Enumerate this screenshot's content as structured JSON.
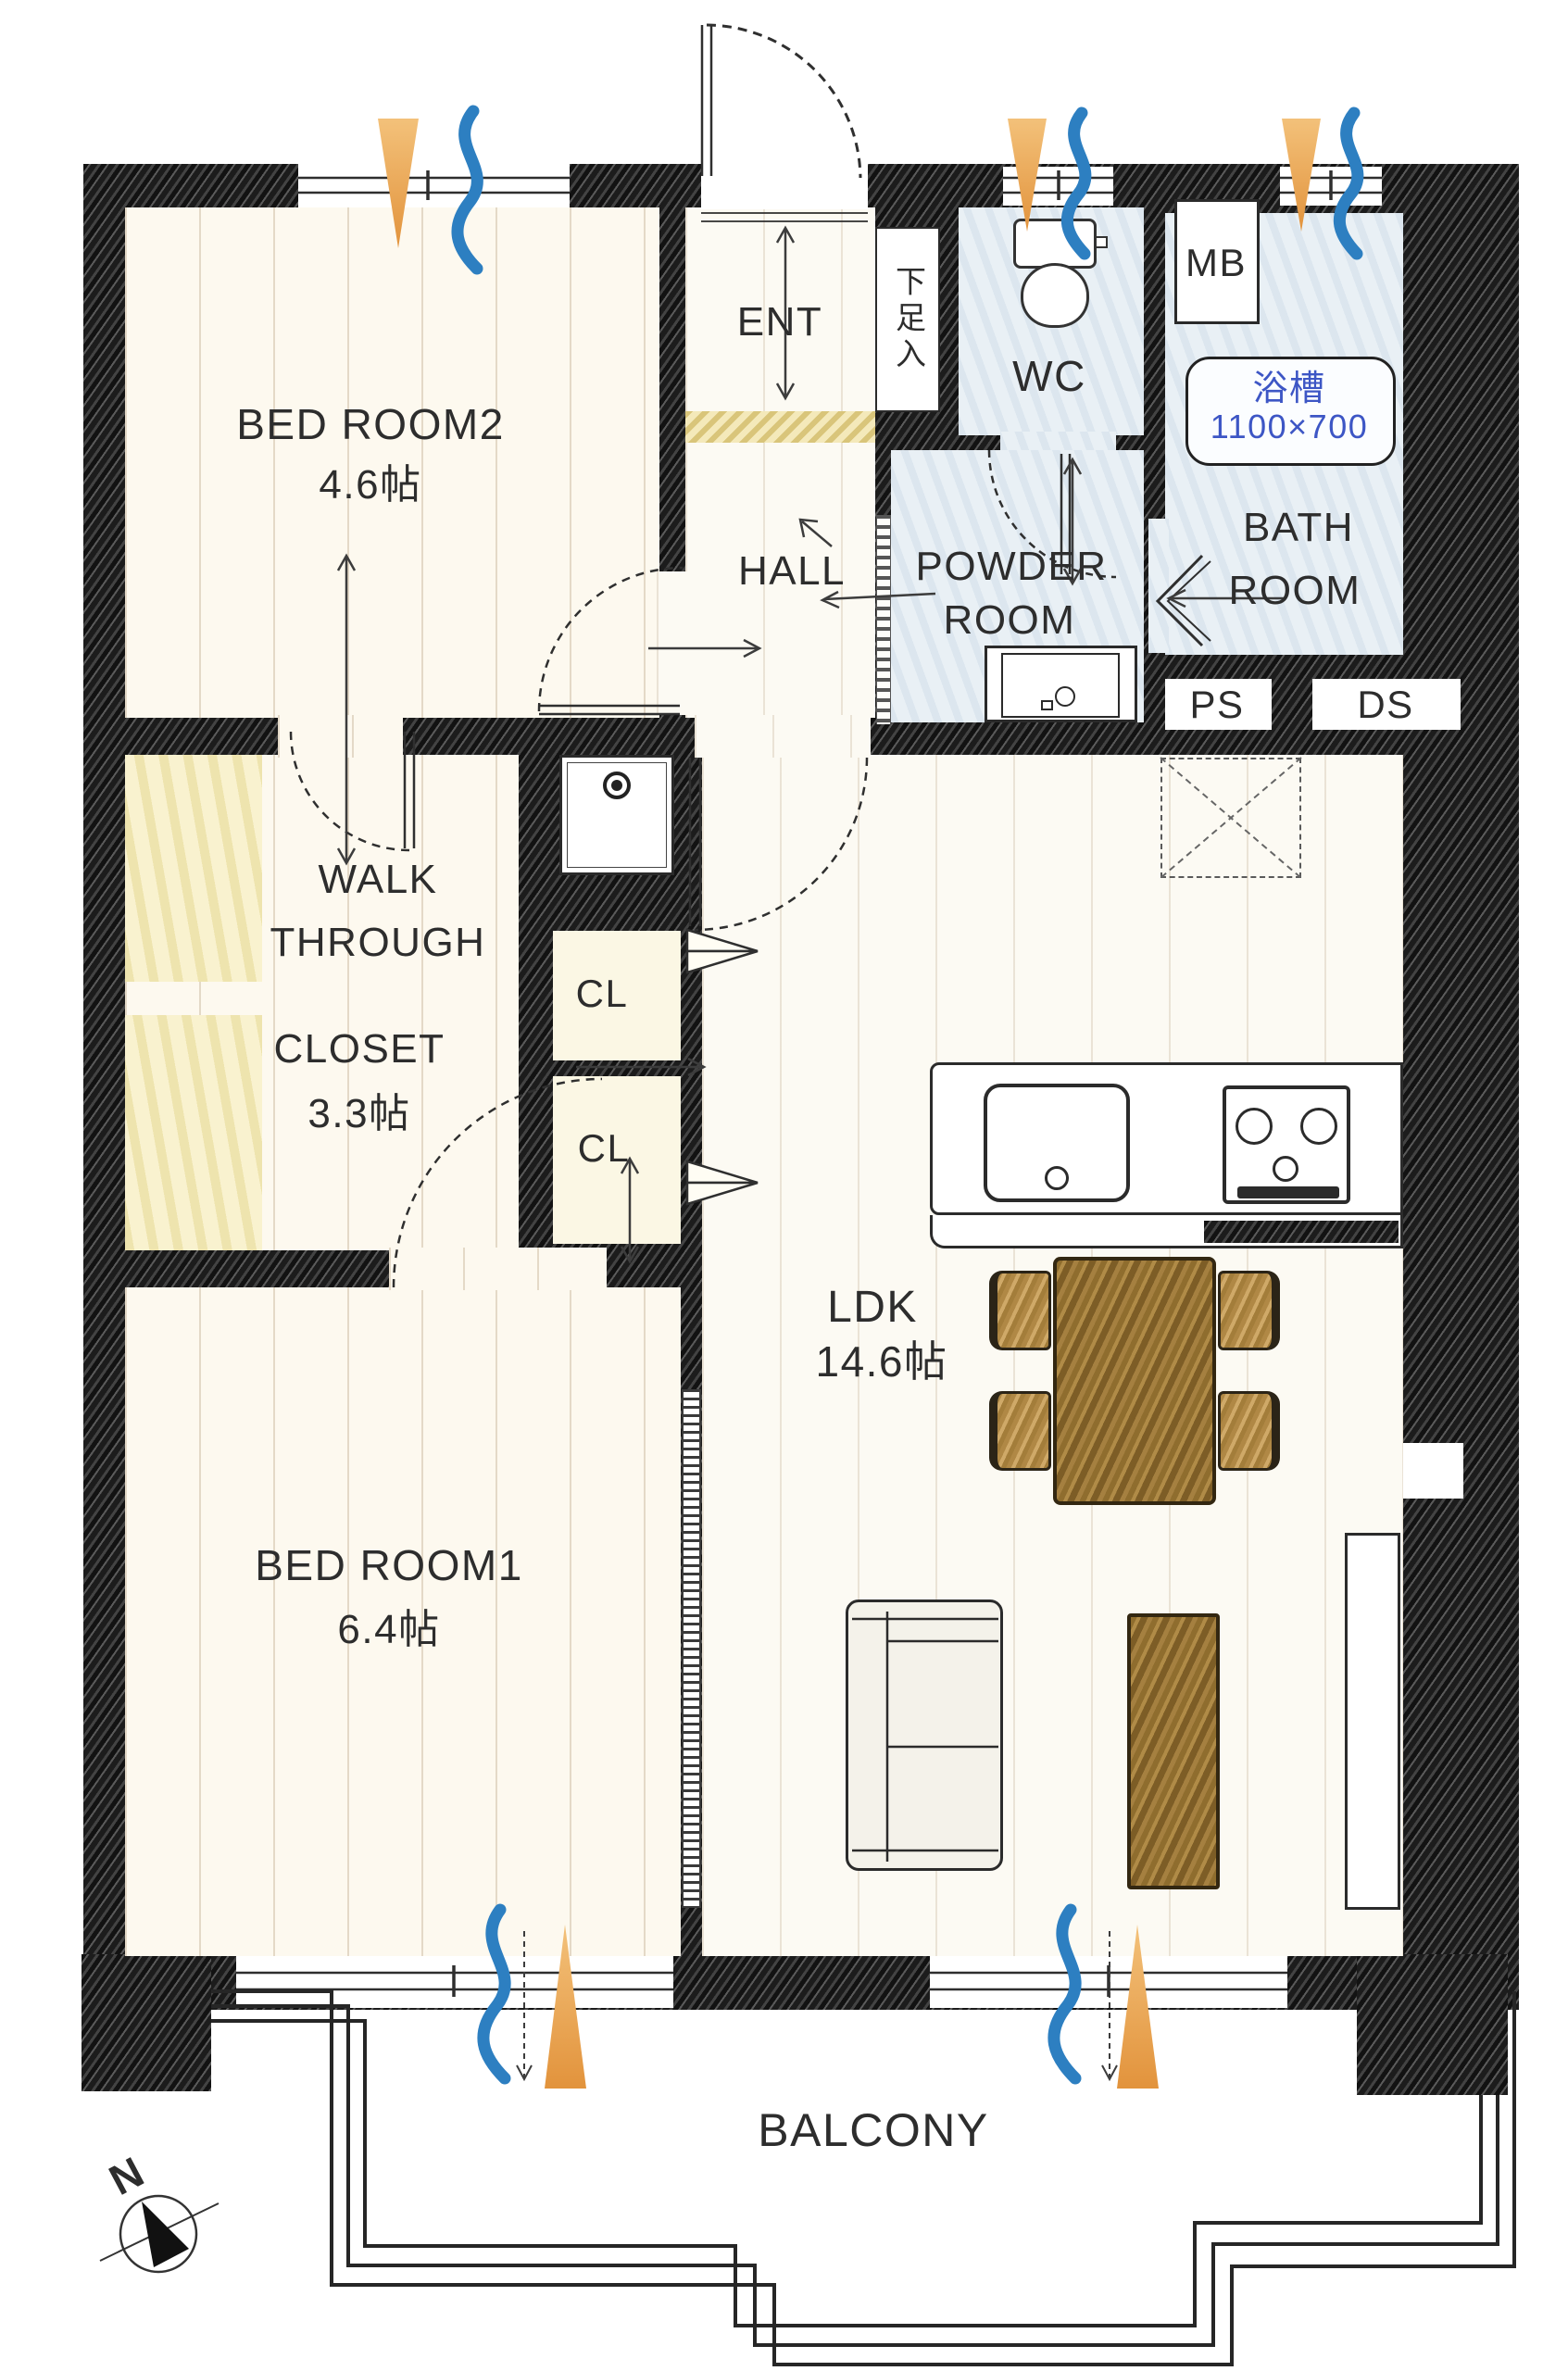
{
  "plan_type": "apartment-floor-plan",
  "rooms": {
    "bedroom2": {
      "name": "BED ROOM2",
      "size": "4.6帖"
    },
    "bedroom1": {
      "name": "BED ROOM1",
      "size": "6.4帖"
    },
    "ldk": {
      "name": "LDK",
      "size": "14.6帖"
    },
    "walkthrough": {
      "l1": "WALK",
      "l2": "THROUGH",
      "l3": "CLOSET",
      "size": "3.3帖"
    },
    "bath": {
      "l1": "BATH",
      "l2": "ROOM",
      "tub_label": "浴槽",
      "tub_size": "1100×700"
    },
    "powder": {
      "l1": "POWDER",
      "l2": "ROOM"
    }
  },
  "labels": {
    "ent": "ENT",
    "hall": "HALL",
    "wc": "WC",
    "mb": "MB",
    "ps": "PS",
    "ds": "DS",
    "shoe_cabinet": "下足入",
    "cl1": "CL",
    "cl2": "CL",
    "balcony": "BALCONY",
    "compass_north": "N"
  },
  "colors": {
    "wall": "#2f2f2f",
    "floor": "#fdf9ef",
    "closet_yellow": "#f9f2cf",
    "wet_area_blue": "#e9f0f5",
    "tub_text_blue": "#3d56c5",
    "sunlight_arrow_orange": "#eca24b",
    "airflow_wave_blue": "#2d7fc1",
    "furniture_wood": "#a5803f"
  },
  "icons": {
    "sunlight_arrows": 5,
    "airflow_waves": 5,
    "compass": "north-up-left"
  }
}
